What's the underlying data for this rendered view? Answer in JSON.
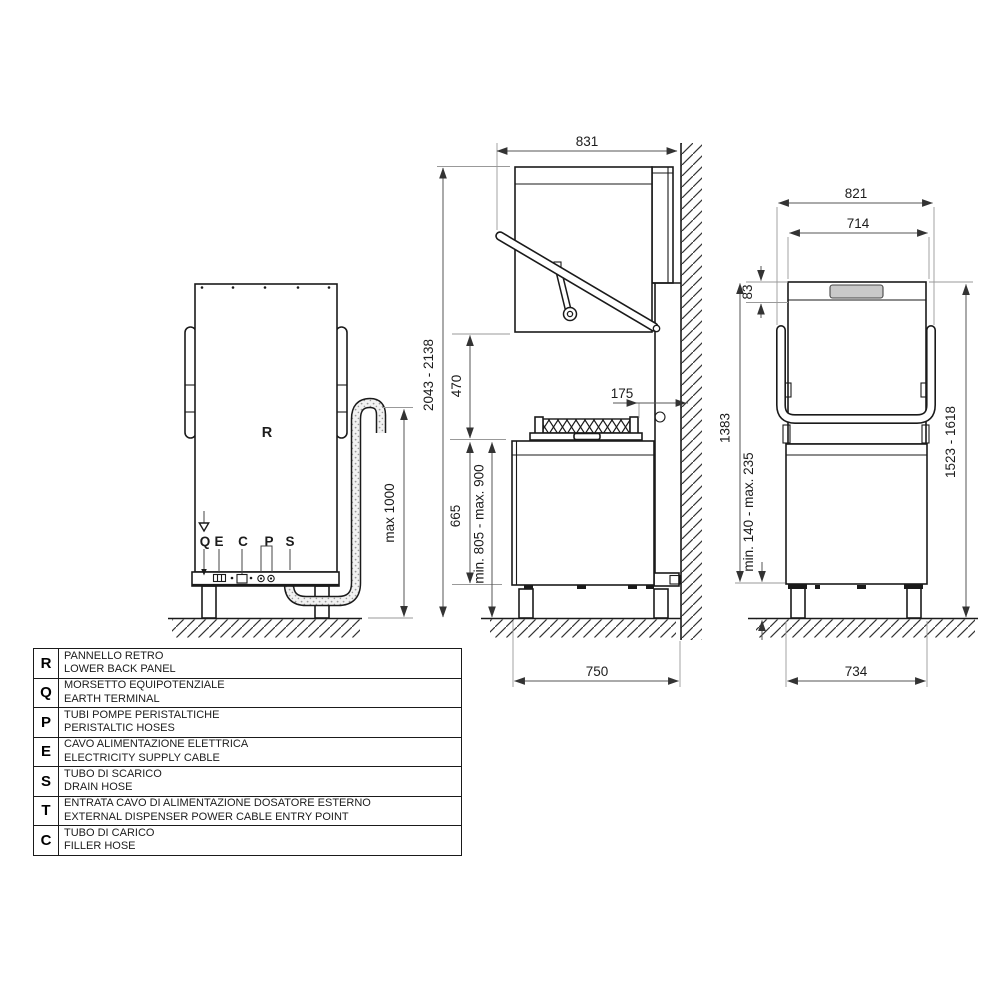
{
  "views": {
    "back": {
      "panel_label": "R",
      "labels": {
        "q": "Q",
        "e": "E",
        "c": "C",
        "p": "P",
        "s": "S"
      },
      "dims": {
        "drain_height": "max 1000"
      }
    },
    "side": {
      "dims": {
        "total_depth": "831",
        "total_height": "2043 - 2138",
        "hood_clearance": "470",
        "body_height": "665",
        "work_height": "min. 805 - max. 900",
        "wall_gap": "175",
        "base_depth": "750"
      }
    },
    "front": {
      "dims": {
        "outer_width": "821",
        "hood_width": "714",
        "top_band": "83",
        "body_height": "1383",
        "leg_height": "min. 140 - max. 235",
        "total_height": "1523 - 1618",
        "base_width": "734"
      }
    }
  },
  "legend": {
    "rows": [
      {
        "letter": "R",
        "it": "PANNELLO RETRO",
        "en": "LOWER BACK PANEL"
      },
      {
        "letter": "Q",
        "it": "MORSETTO EQUIPOTENZIALE",
        "en": "EARTH TERMINAL"
      },
      {
        "letter": "P",
        "it": "TUBI POMPE PERISTALTICHE",
        "en": "PERISTALTIC HOSES"
      },
      {
        "letter": "E",
        "it": "CAVO ALIMENTAZIONE ELETTRICA",
        "en": "ELECTRICITY SUPPLY CABLE"
      },
      {
        "letter": "S",
        "it": "TUBO DI SCARICO",
        "en": "DRAIN HOSE"
      },
      {
        "letter": "T",
        "it": "ENTRATA CAVO DI ALIMENTAZIONE DOSATORE ESTERNO",
        "en": "EXTERNAL DISPENSER POWER CABLE ENTRY POINT"
      },
      {
        "letter": "C",
        "it": "TUBO DI CARICO",
        "en": "FILLER HOSE"
      }
    ]
  },
  "colors": {
    "line": "#1a1a1a",
    "dimension": "#555555",
    "display_fill": "#c9c9c9"
  }
}
